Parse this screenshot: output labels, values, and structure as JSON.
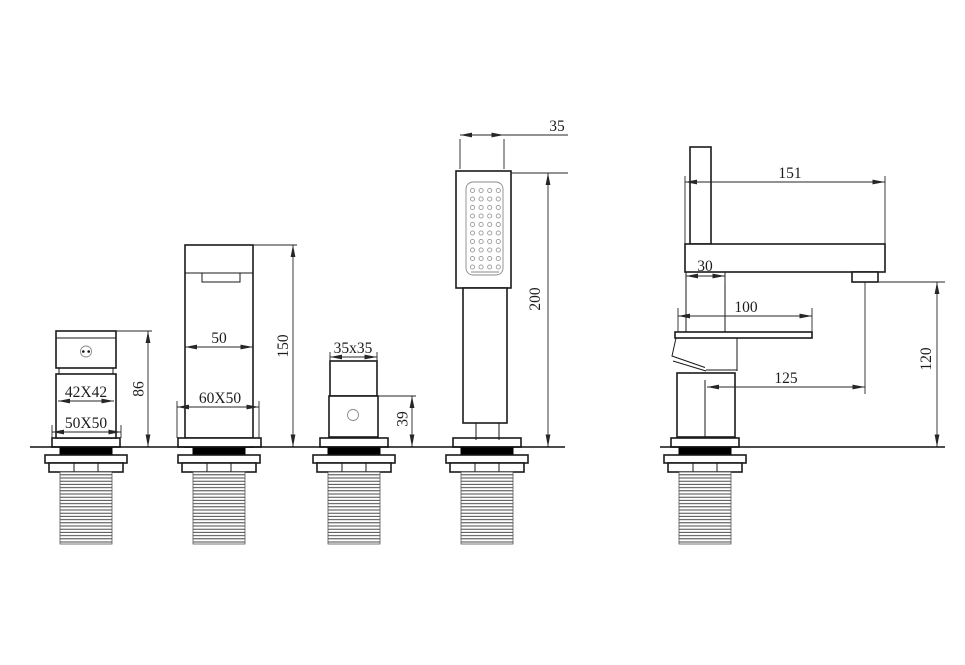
{
  "drawing": {
    "subject": "4-hole deck-mounted bathtub mixer faucet with handshower - dimensioned technical drawing",
    "units": "mm",
    "front_view": {
      "control_valve": {
        "width_label": "42X42",
        "base_label": "50X50",
        "height_label": "86"
      },
      "spout": {
        "width_label": "50",
        "base_label": "60X50",
        "height_label": "150"
      },
      "diverter": {
        "size_label": "35x35",
        "height_label": "39"
      },
      "handshower": {
        "head_width_label": "35",
        "height_label": "200"
      }
    },
    "side_view": {
      "arm_length_label": "151",
      "handle_width_label": "30",
      "lever_length_label": "100",
      "spout_reach_label": "125",
      "spout_height_label": "120"
    },
    "colors": {
      "outline": "#1a1a1a",
      "dimension": "#262626",
      "text": "#1c1c1c",
      "gasket": "#000000",
      "nozzle": "#999999",
      "background": "#ffffff"
    }
  }
}
